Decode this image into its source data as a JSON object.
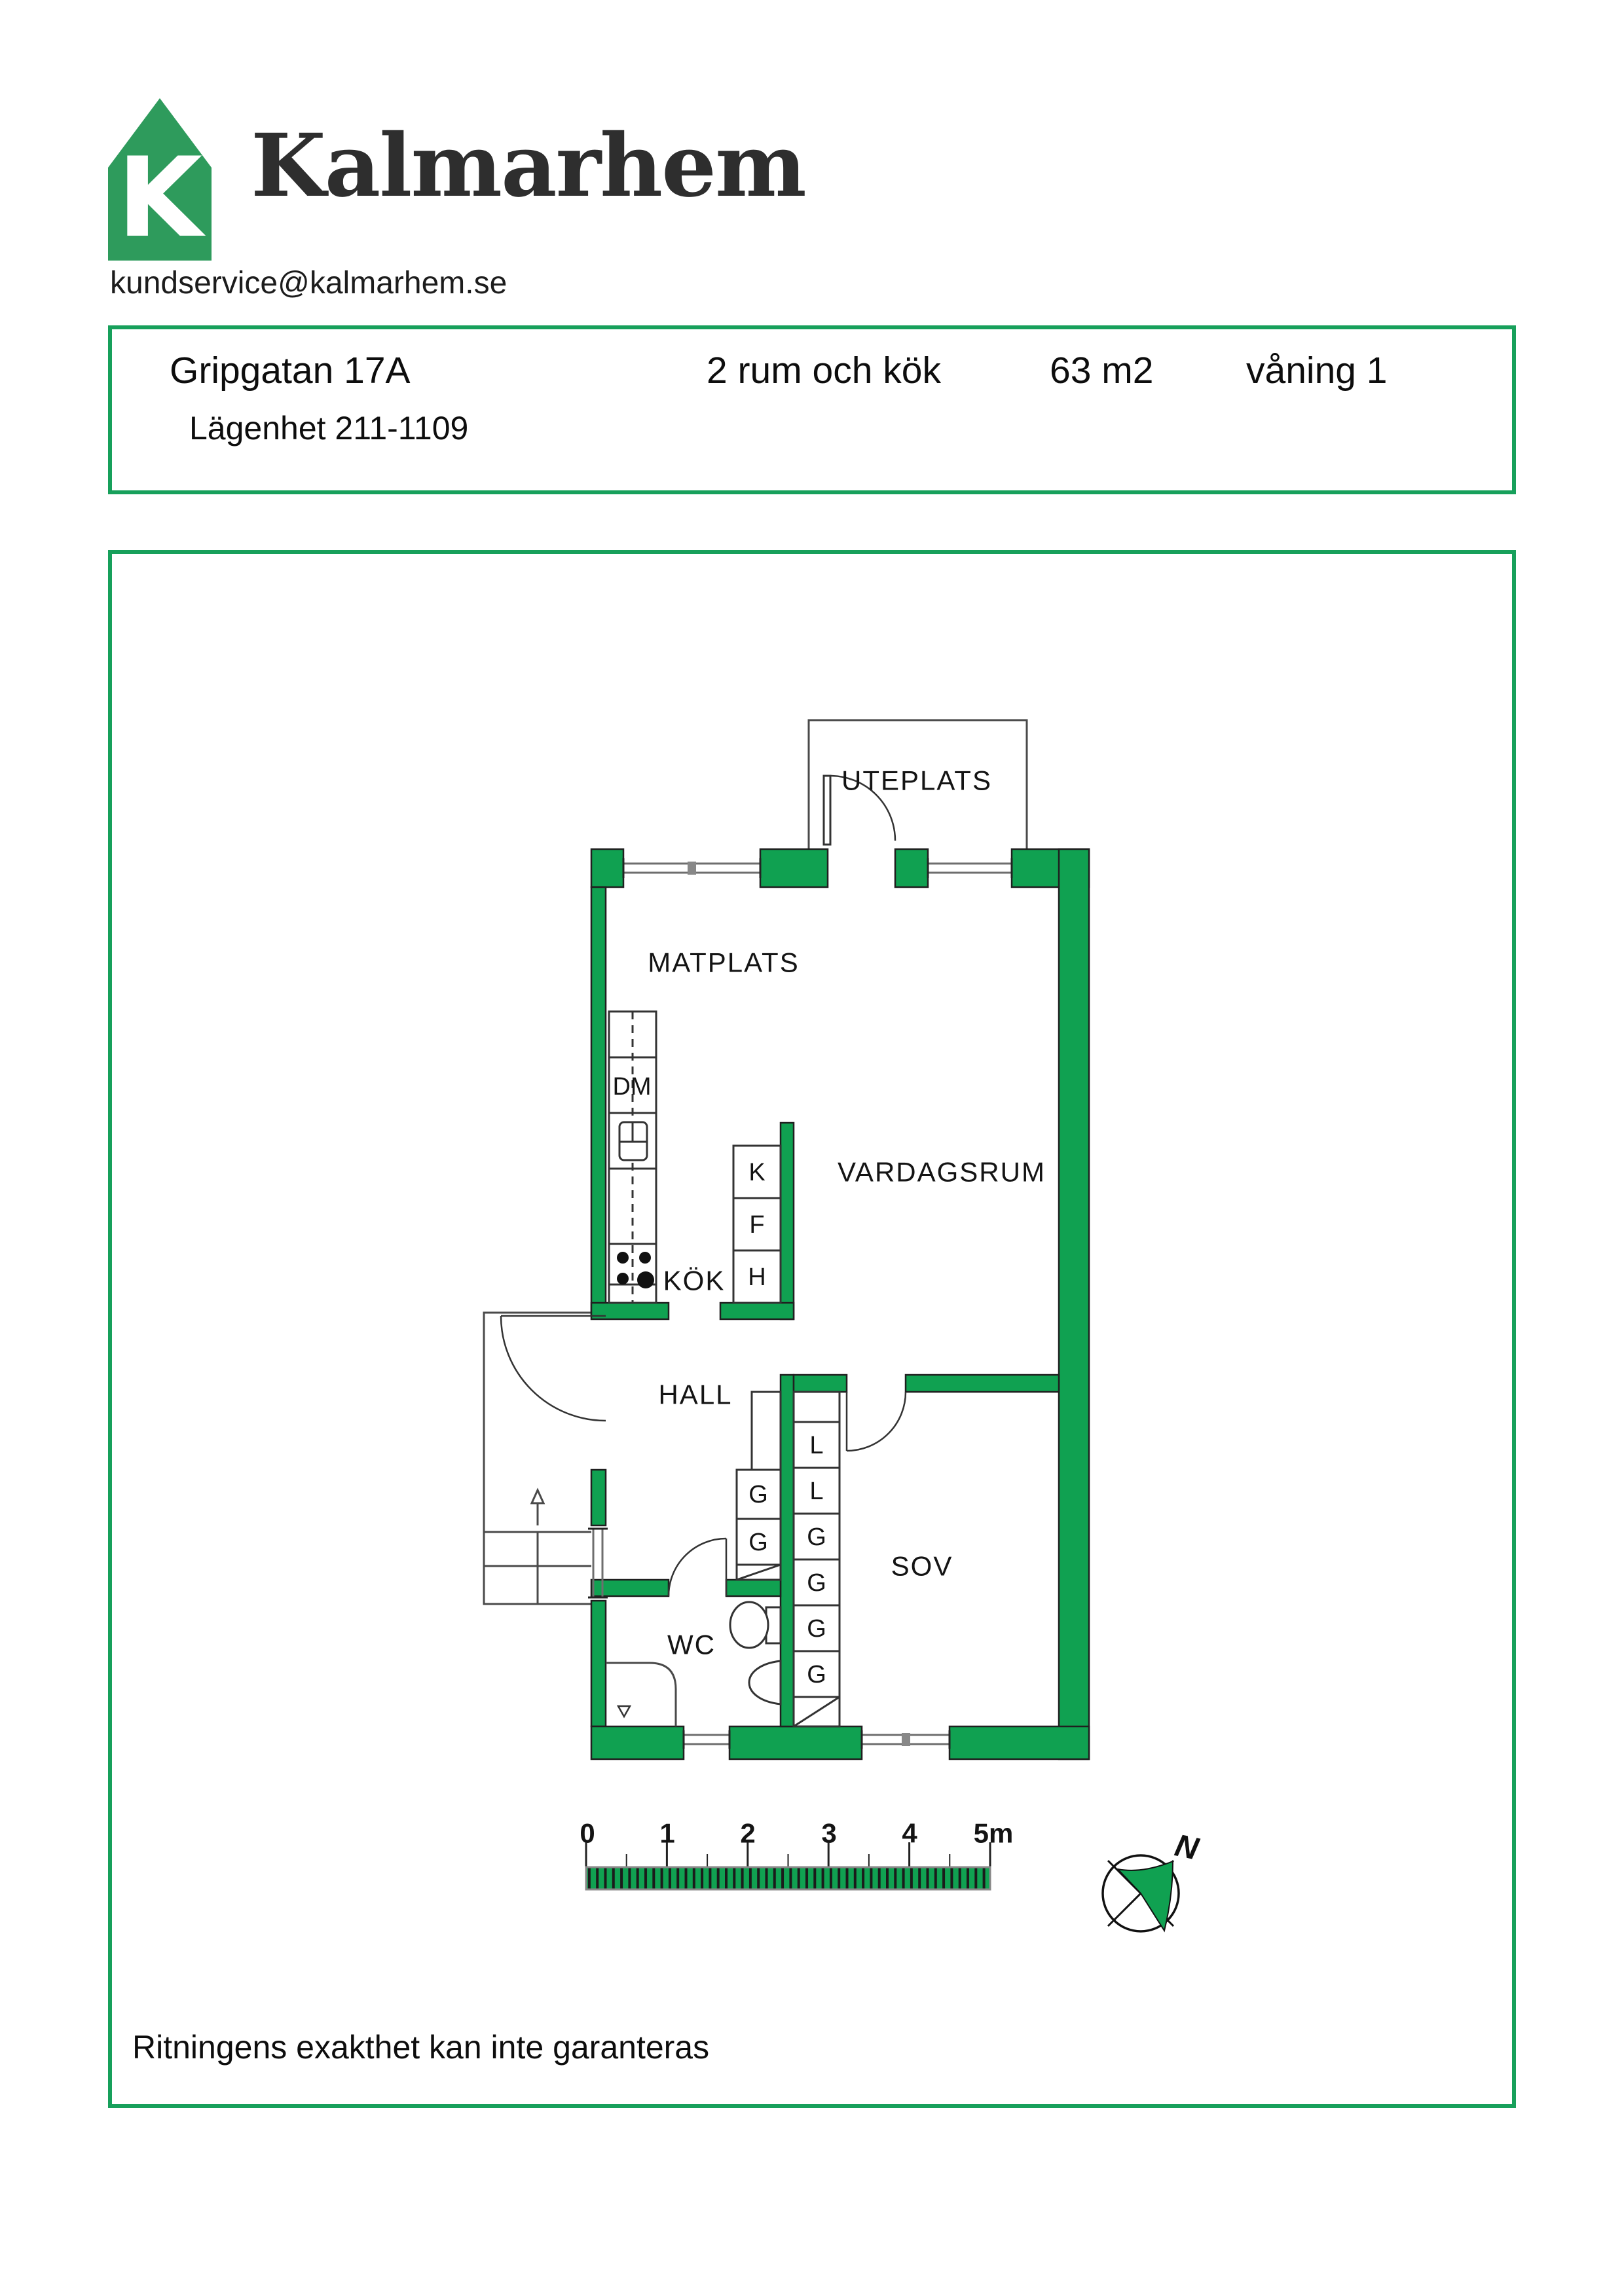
{
  "colors": {
    "brand_green": "#2E9B5C",
    "wall_green": "#10A151",
    "border_green": "#17A05B"
  },
  "header": {
    "logo_letter": "K",
    "brand_name": "Kalmarhem",
    "email": "kundservice@kalmarhem.se"
  },
  "info_box": {
    "address": "Gripgatan 17A",
    "apartment_id": "Lägenhet 211-1109",
    "layout": "2 rum och kök",
    "area": "63 m2",
    "floor": "våning 1"
  },
  "floor_plan": {
    "room_labels": {
      "uteplats": "UTEPLATS",
      "matplats": "MATPLATS",
      "vardagsrum": "VARDAGSRUM",
      "kok": "KÖK",
      "hall": "HALL",
      "sov": "SOV",
      "wc": "WC"
    },
    "appliance_labels": {
      "dishwasher": "DM"
    },
    "kfh_column": [
      "K",
      "F",
      "H"
    ],
    "hall_closets": [
      "G",
      "G"
    ],
    "sov_closets": [
      "L",
      "L",
      "G",
      "G",
      "G",
      "G"
    ]
  },
  "scale_bar": {
    "tick_labels": [
      "0",
      "1",
      "2",
      "3",
      "4",
      "5m"
    ]
  },
  "compass": {
    "north": "N"
  },
  "footer": {
    "disclaimer": "Ritningens exakthet kan inte garanteras"
  }
}
